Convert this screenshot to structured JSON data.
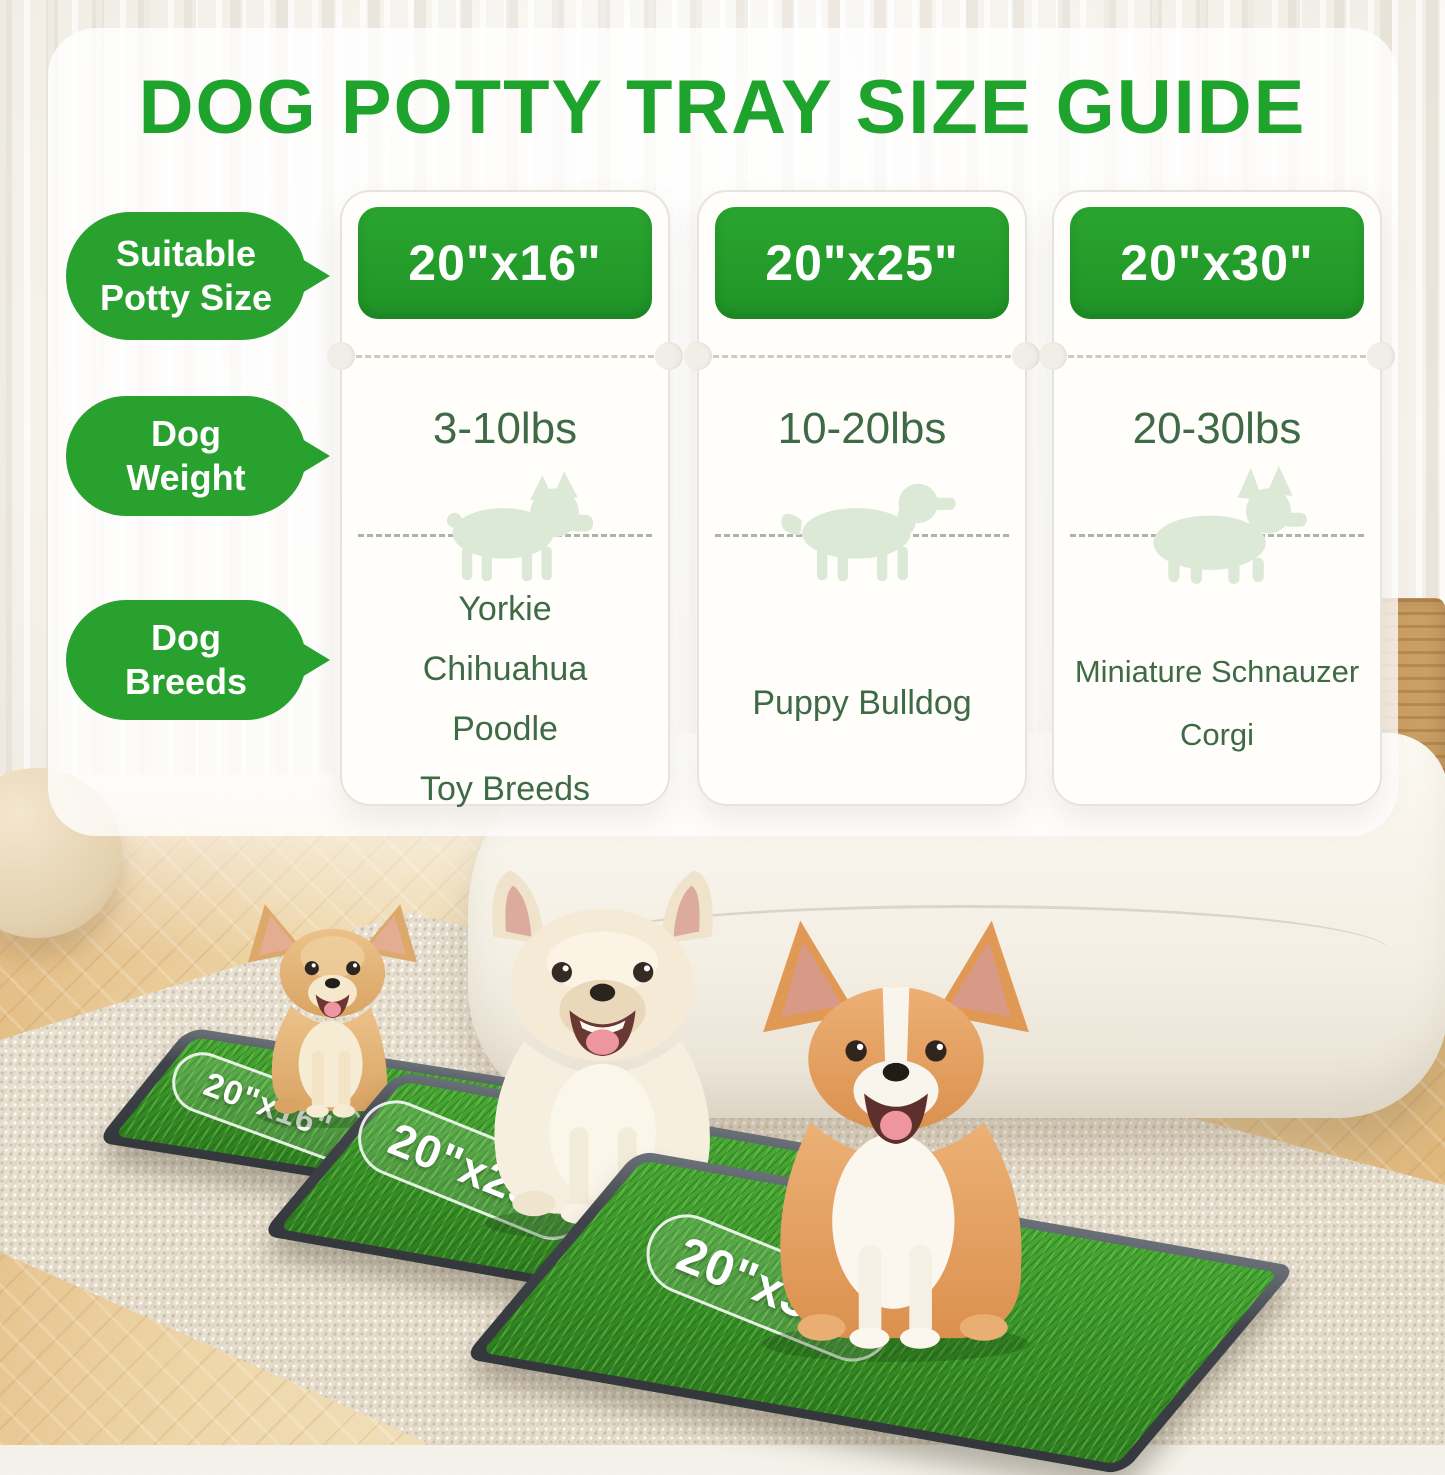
{
  "title": "DOG POTTY TRAY SIZE GUIDE",
  "row_labels": {
    "size": "Suitable\nPotty Size",
    "weight": "Dog\nWeight",
    "breeds": "Dog\nBreeds"
  },
  "columns": [
    {
      "size": "20\"x16\"",
      "weight": "3-10lbs",
      "silhouette": "french-bulldog",
      "breeds": [
        "Yorkie",
        "Chihuahua",
        "Poodle",
        "Toy Breeds"
      ]
    },
    {
      "size": "20\"x25\"",
      "weight": "10-20lbs",
      "silhouette": "spaniel",
      "breeds": [
        "Puppy Bulldog"
      ]
    },
    {
      "size": "20\"x30\"",
      "weight": "20-30lbs",
      "silhouette": "corgi",
      "breeds": [
        "Miniature Schnauzer",
        "Corgi"
      ]
    }
  ],
  "scene": {
    "tray_labels": [
      "20\"x16\"",
      "20\"x25\"",
      "20\"x30\""
    ],
    "dogs": [
      "chihuahua",
      "french-bulldog",
      "corgi"
    ]
  },
  "colors": {
    "accent_green": "#22A12E",
    "dark_green_text": "#3E6B46",
    "silhouette_green": "#DBE9D6",
    "grass_green": "#3E9D2E"
  }
}
